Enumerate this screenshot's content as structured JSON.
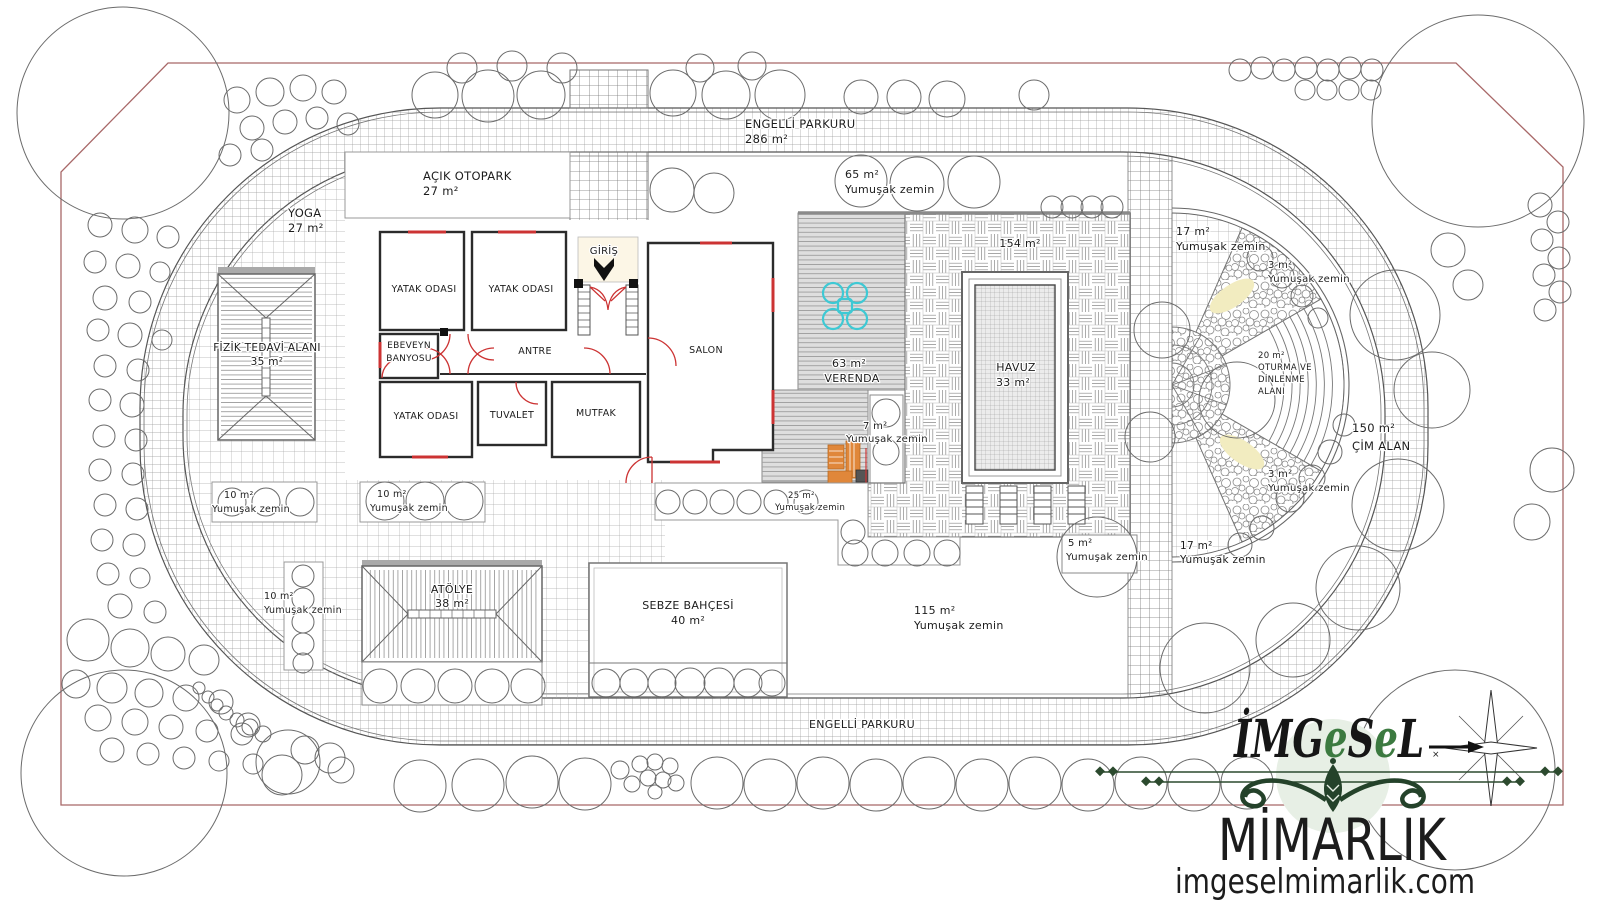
{
  "meta": {
    "drawing_type": "architectural landscape site plan",
    "language": "Turkish"
  },
  "palette": {
    "boundary_line": "#a86868",
    "drawing_line": "#6b6b6b",
    "wall": "#2b2b2b",
    "door_window": "#cc3333",
    "veranda_fill": "#dedede",
    "furniture_cyan": "#3ec9d4",
    "furniture_orange": "#e0873a",
    "pebble_highlight": "#f2ecc0",
    "logo_green": "#24422a",
    "logo_circle": "#e7efe5"
  },
  "plan": {
    "labels": [
      {
        "t": "ENGELLİ PARKURU",
        "x": 745,
        "y": 128,
        "s": 11.5,
        "a": "s"
      },
      {
        "t": "286 m²",
        "x": 745,
        "y": 143,
        "s": 11.5,
        "a": "s"
      },
      {
        "t": "65 m²",
        "x": 845,
        "y": 178,
        "s": 11,
        "a": "s"
      },
      {
        "t": "Yumuşak zemin",
        "x": 845,
        "y": 193,
        "s": 11,
        "a": "s"
      },
      {
        "t": "YOGA",
        "x": 288,
        "y": 217,
        "s": 11.5,
        "a": "s"
      },
      {
        "t": "27 m²",
        "x": 288,
        "y": 232,
        "s": 11.5,
        "a": "s"
      },
      {
        "t": "AÇIK OTOPARK",
        "x": 423,
        "y": 180,
        "s": 11.5,
        "a": "s"
      },
      {
        "t": "27 m²",
        "x": 423,
        "y": 195,
        "s": 11.5,
        "a": "s"
      },
      {
        "t": "GİRİŞ",
        "x": 604,
        "y": 254,
        "s": 10,
        "a": "m"
      },
      {
        "t": "YATAK ODASI",
        "x": 424,
        "y": 292,
        "s": 9.5,
        "a": "m"
      },
      {
        "t": "YATAK ODASI",
        "x": 521,
        "y": 292,
        "s": 9.5,
        "a": "m"
      },
      {
        "t": "EBEVEYN",
        "x": 409,
        "y": 348,
        "s": 9,
        "a": "m"
      },
      {
        "t": "BANYOSU",
        "x": 409,
        "y": 361,
        "s": 9,
        "a": "m"
      },
      {
        "t": "ANTRE",
        "x": 535,
        "y": 354,
        "s": 9.5,
        "a": "m"
      },
      {
        "t": "SALON",
        "x": 706,
        "y": 353,
        "s": 9.5,
        "a": "m"
      },
      {
        "t": "YATAK ODASI",
        "x": 426,
        "y": 419,
        "s": 9.5,
        "a": "m"
      },
      {
        "t": "TUVALET",
        "x": 512,
        "y": 418,
        "s": 9.5,
        "a": "m"
      },
      {
        "t": "MUTFAK",
        "x": 596,
        "y": 416,
        "s": 9.5,
        "a": "m"
      },
      {
        "t": "63 m²",
        "x": 849,
        "y": 367,
        "s": 11,
        "a": "m"
      },
      {
        "t": "VERENDA",
        "x": 852,
        "y": 382,
        "s": 11,
        "a": "m"
      },
      {
        "t": "7 m²",
        "x": 863,
        "y": 429,
        "s": 10,
        "a": "s"
      },
      {
        "t": "Yumuşak zemin",
        "x": 846,
        "y": 442,
        "s": 10,
        "a": "s"
      },
      {
        "t": "154 m²",
        "x": 1020,
        "y": 247,
        "s": 11,
        "a": "m"
      },
      {
        "t": "HAVUZ",
        "x": 1016,
        "y": 371,
        "s": 11,
        "a": "m"
      },
      {
        "t": "33 m²",
        "x": 1013,
        "y": 386,
        "s": 11,
        "a": "m"
      },
      {
        "t": "25 m²",
        "x": 788,
        "y": 498,
        "s": 8.5,
        "a": "s"
      },
      {
        "t": "Yumuşak zemin",
        "x": 775,
        "y": 510,
        "s": 8.5,
        "a": "s"
      },
      {
        "t": "5 m²",
        "x": 1068,
        "y": 546,
        "s": 10,
        "a": "s"
      },
      {
        "t": "Yumuşak zemin",
        "x": 1066,
        "y": 560,
        "s": 10,
        "a": "s"
      },
      {
        "t": "115 m²",
        "x": 914,
        "y": 614,
        "s": 11,
        "a": "s"
      },
      {
        "t": "Yumuşak zemin",
        "x": 914,
        "y": 629,
        "s": 11,
        "a": "s"
      },
      {
        "t": "SEBZE BAHÇESİ",
        "x": 688,
        "y": 609,
        "s": 11,
        "a": "m"
      },
      {
        "t": "40 m²",
        "x": 688,
        "y": 624,
        "s": 11,
        "a": "m"
      },
      {
        "t": "ATÖLYE",
        "x": 452,
        "y": 593,
        "s": 11,
        "a": "m"
      },
      {
        "t": "38 m²",
        "x": 452,
        "y": 607,
        "s": 11,
        "a": "m"
      },
      {
        "t": "10 m²",
        "x": 224,
        "y": 498,
        "s": 9.5,
        "a": "s"
      },
      {
        "t": "Yumuşak zemin",
        "x": 212,
        "y": 512,
        "s": 9.5,
        "a": "s"
      },
      {
        "t": "10 m²",
        "x": 377,
        "y": 497,
        "s": 9.5,
        "a": "s"
      },
      {
        "t": "Yumuşak zemin",
        "x": 370,
        "y": 511,
        "s": 9.5,
        "a": "s"
      },
      {
        "t": "10 m²",
        "x": 264,
        "y": 599,
        "s": 9.5,
        "a": "s"
      },
      {
        "t": "Yumuşak zemin",
        "x": 264,
        "y": 613,
        "s": 9.5,
        "a": "s"
      },
      {
        "t": "FİZİK TEDAVİ ALANI",
        "x": 267,
        "y": 351,
        "s": 10.5,
        "a": "m"
      },
      {
        "t": "35 m²",
        "x": 267,
        "y": 365,
        "s": 10.5,
        "a": "m"
      },
      {
        "t": "17 m²",
        "x": 1176,
        "y": 235,
        "s": 11,
        "a": "s"
      },
      {
        "t": "Yumuşak zemin",
        "x": 1176,
        "y": 250,
        "s": 11,
        "a": "s"
      },
      {
        "t": "3 m²",
        "x": 1268,
        "y": 268,
        "s": 10,
        "a": "s"
      },
      {
        "t": "Yumuşak zemin",
        "x": 1268,
        "y": 282,
        "s": 10,
        "a": "s"
      },
      {
        "t": "20 m²",
        "x": 1258,
        "y": 358,
        "s": 8.5,
        "a": "s"
      },
      {
        "t": "OTURMA VE",
        "x": 1258,
        "y": 370,
        "s": 8.5,
        "a": "s"
      },
      {
        "t": "DİNLENME",
        "x": 1258,
        "y": 382,
        "s": 8.5,
        "a": "s"
      },
      {
        "t": "ALANI",
        "x": 1258,
        "y": 394,
        "s": 8.5,
        "a": "s"
      },
      {
        "t": "150 m²",
        "x": 1352,
        "y": 432,
        "s": 11.5,
        "a": "s"
      },
      {
        "t": "ÇİM ALAN",
        "x": 1352,
        "y": 450,
        "s": 11.5,
        "a": "s"
      },
      {
        "t": "3 m²",
        "x": 1268,
        "y": 477,
        "s": 10,
        "a": "s"
      },
      {
        "t": "Yumuşak zemin",
        "x": 1268,
        "y": 491,
        "s": 10,
        "a": "s"
      },
      {
        "t": "17 m²",
        "x": 1180,
        "y": 549,
        "s": 10.5,
        "a": "s"
      },
      {
        "t": "Yumuşak zemin",
        "x": 1180,
        "y": 563,
        "s": 10.5,
        "a": "s"
      },
      {
        "t": "ENGELLİ PARKURU",
        "x": 862,
        "y": 728,
        "s": 11,
        "a": "m"
      }
    ],
    "trees": [
      [
        435,
        95,
        23
      ],
      [
        488,
        96,
        26
      ],
      [
        541,
        95,
        24
      ],
      [
        673,
        93,
        23
      ],
      [
        726,
        95,
        24
      ],
      [
        780,
        95,
        25
      ],
      [
        861,
        97,
        17
      ],
      [
        904,
        97,
        17
      ],
      [
        947,
        99,
        18
      ],
      [
        1034,
        95,
        15
      ],
      [
        462,
        68,
        15
      ],
      [
        512,
        66,
        15
      ],
      [
        562,
        68,
        15
      ],
      [
        700,
        68,
        14
      ],
      [
        752,
        66,
        14
      ],
      [
        1240,
        70,
        11
      ],
      [
        1262,
        68,
        11
      ],
      [
        1284,
        70,
        11
      ],
      [
        1306,
        68,
        11
      ],
      [
        1328,
        70,
        11
      ],
      [
        1350,
        68,
        11
      ],
      [
        1372,
        70,
        11
      ],
      [
        1305,
        90,
        10
      ],
      [
        1327,
        90,
        10
      ],
      [
        1349,
        90,
        10
      ],
      [
        1371,
        90,
        10
      ],
      [
        672,
        190,
        22
      ],
      [
        714,
        193,
        20
      ],
      [
        861,
        181,
        26
      ],
      [
        917,
        184,
        27
      ],
      [
        974,
        182,
        26
      ],
      [
        1052,
        207,
        11
      ],
      [
        1072,
        207,
        11
      ],
      [
        1092,
        207,
        11
      ],
      [
        1112,
        207,
        11
      ],
      [
        123,
        113,
        106
      ],
      [
        1478,
        121,
        106
      ],
      [
        124,
        773,
        103
      ],
      [
        1455,
        770,
        100
      ],
      [
        237,
        100,
        13
      ],
      [
        270,
        92,
        14
      ],
      [
        303,
        88,
        13
      ],
      [
        334,
        92,
        12
      ],
      [
        252,
        128,
        12
      ],
      [
        285,
        122,
        12
      ],
      [
        317,
        118,
        11
      ],
      [
        348,
        124,
        11
      ],
      [
        230,
        155,
        11
      ],
      [
        262,
        150,
        11
      ],
      [
        100,
        225,
        12
      ],
      [
        135,
        230,
        13
      ],
      [
        168,
        237,
        11
      ],
      [
        95,
        262,
        11
      ],
      [
        128,
        266,
        12
      ],
      [
        160,
        272,
        10
      ],
      [
        105,
        298,
        12
      ],
      [
        140,
        302,
        11
      ],
      [
        98,
        330,
        11
      ],
      [
        130,
        335,
        12
      ],
      [
        162,
        340,
        10
      ],
      [
        105,
        366,
        11
      ],
      [
        138,
        370,
        11
      ],
      [
        100,
        400,
        11
      ],
      [
        132,
        405,
        12
      ],
      [
        104,
        436,
        11
      ],
      [
        136,
        440,
        11
      ],
      [
        100,
        470,
        11
      ],
      [
        133,
        474,
        11
      ],
      [
        105,
        505,
        11
      ],
      [
        137,
        509,
        11
      ],
      [
        102,
        540,
        11
      ],
      [
        134,
        545,
        11
      ],
      [
        108,
        574,
        11
      ],
      [
        140,
        578,
        10
      ],
      [
        120,
        606,
        12
      ],
      [
        155,
        612,
        11
      ],
      [
        88,
        640,
        21
      ],
      [
        130,
        648,
        19
      ],
      [
        168,
        654,
        17
      ],
      [
        204,
        660,
        15
      ],
      [
        76,
        684,
        14
      ],
      [
        112,
        688,
        15
      ],
      [
        149,
        693,
        14
      ],
      [
        186,
        698,
        13
      ],
      [
        221,
        702,
        12
      ],
      [
        98,
        718,
        13
      ],
      [
        135,
        722,
        13
      ],
      [
        171,
        727,
        12
      ],
      [
        207,
        731,
        11
      ],
      [
        242,
        734,
        11
      ],
      [
        112,
        750,
        12
      ],
      [
        148,
        754,
        11
      ],
      [
        184,
        758,
        11
      ],
      [
        219,
        761,
        10
      ],
      [
        253,
        764,
        10
      ],
      [
        199,
        688,
        6
      ],
      [
        208,
        697,
        6
      ],
      [
        217,
        705,
        6
      ],
      [
        226,
        713,
        7
      ],
      [
        237,
        720,
        7
      ],
      [
        250,
        727,
        8
      ],
      [
        263,
        734,
        8
      ],
      [
        248,
        725,
        12
      ],
      [
        288,
        762,
        32
      ],
      [
        282,
        775,
        20
      ],
      [
        305,
        750,
        14
      ],
      [
        330,
        758,
        15
      ],
      [
        341,
        770,
        13
      ],
      [
        420,
        786,
        26
      ],
      [
        478,
        785,
        26
      ],
      [
        532,
        782,
        26
      ],
      [
        585,
        784,
        26
      ],
      [
        717,
        783,
        26
      ],
      [
        770,
        785,
        26
      ],
      [
        823,
        783,
        26
      ],
      [
        876,
        785,
        26
      ],
      [
        929,
        783,
        26
      ],
      [
        982,
        785,
        26
      ],
      [
        1035,
        783,
        26
      ],
      [
        1088,
        785,
        26
      ],
      [
        1141,
        783,
        26
      ],
      [
        1194,
        785,
        26
      ],
      [
        1247,
        783,
        26
      ],
      [
        640,
        764,
        8
      ],
      [
        655,
        762,
        8
      ],
      [
        670,
        766,
        8
      ],
      [
        648,
        778,
        8
      ],
      [
        663,
        780,
        8
      ],
      [
        676,
        783,
        8
      ],
      [
        655,
        792,
        7
      ],
      [
        620,
        770,
        9
      ],
      [
        632,
        784,
        8
      ],
      [
        1395,
        315,
        45
      ],
      [
        1432,
        390,
        38
      ],
      [
        1398,
        505,
        46
      ],
      [
        1358,
        588,
        42
      ],
      [
        1293,
        640,
        37
      ],
      [
        1205,
        668,
        45
      ],
      [
        1540,
        205,
        12
      ],
      [
        1558,
        222,
        11
      ],
      [
        1542,
        240,
        11
      ],
      [
        1559,
        258,
        11
      ],
      [
        1544,
        275,
        11
      ],
      [
        1560,
        292,
        11
      ],
      [
        1545,
        310,
        11
      ],
      [
        1448,
        250,
        17
      ],
      [
        1468,
        285,
        15
      ],
      [
        1552,
        470,
        22
      ],
      [
        1532,
        522,
        18
      ],
      [
        1162,
        330,
        28
      ],
      [
        1237,
        400,
        38
      ],
      [
        1150,
        437,
        25
      ],
      [
        1260,
        258,
        13
      ],
      [
        1282,
        276,
        12
      ],
      [
        1302,
        296,
        11
      ],
      [
        1318,
        318,
        10
      ],
      [
        1290,
        498,
        14
      ],
      [
        1312,
        478,
        13
      ],
      [
        1330,
        452,
        12
      ],
      [
        1344,
        425,
        11
      ],
      [
        1240,
        545,
        12
      ],
      [
        1262,
        528,
        12
      ],
      [
        1097,
        557,
        40
      ],
      [
        886,
        413,
        14
      ],
      [
        886,
        452,
        13
      ],
      [
        668,
        502,
        12
      ],
      [
        695,
        502,
        12
      ],
      [
        722,
        502,
        12
      ],
      [
        749,
        502,
        12
      ],
      [
        776,
        502,
        12
      ],
      [
        806,
        502,
        12
      ],
      [
        853,
        532,
        12
      ],
      [
        855,
        553,
        13
      ],
      [
        885,
        553,
        13
      ],
      [
        917,
        553,
        13
      ],
      [
        947,
        553,
        13
      ],
      [
        232,
        502,
        14
      ],
      [
        266,
        502,
        14
      ],
      [
        300,
        502,
        14
      ],
      [
        385,
        501,
        19
      ],
      [
        425,
        501,
        19
      ],
      [
        464,
        501,
        19
      ],
      [
        303,
        576,
        11
      ],
      [
        303,
        599,
        11
      ],
      [
        303,
        622,
        11
      ],
      [
        303,
        644,
        11
      ],
      [
        303,
        663,
        10
      ],
      [
        380,
        686,
        17
      ],
      [
        418,
        686,
        17
      ],
      [
        455,
        686,
        17
      ],
      [
        492,
        686,
        17
      ],
      [
        528,
        686,
        17
      ],
      [
        606,
        683,
        14
      ],
      [
        634,
        683,
        14
      ],
      [
        662,
        683,
        14
      ],
      [
        690,
        683,
        15
      ],
      [
        719,
        683,
        15
      ],
      [
        748,
        683,
        14
      ],
      [
        772,
        683,
        13
      ]
    ]
  },
  "logo": {
    "brand_parts": [
      {
        "t": "İM",
        "c": "#161616"
      },
      {
        "t": "G",
        "c": "#161616"
      },
      {
        "t": "e",
        "c": "#3c7a40"
      },
      {
        "t": "S",
        "c": "#161616"
      },
      {
        "t": "e",
        "c": "#3c7a40"
      },
      {
        "t": "L",
        "c": "#161616"
      }
    ],
    "company": "MİMARLIK",
    "website": "imgeselmimarlik.com"
  }
}
